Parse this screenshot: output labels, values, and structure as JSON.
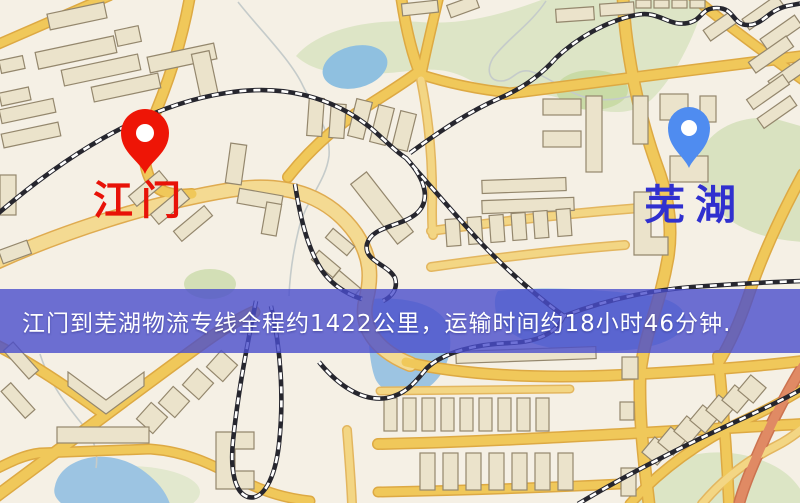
{
  "map": {
    "origin_label": "江门",
    "destination_label": "芜湖",
    "origin_pin_color": "#ee1506",
    "destination_pin_color": "#4f8cf0",
    "origin_label_color": "#e81208",
    "destination_label_color": "#3030cf"
  },
  "banner": {
    "text": "江门到芜湖物流专线全程约1422公里，运输时间约18小时46分钟.",
    "background": "#4a4ecc",
    "text_color": "#ffffff"
  },
  "route_info": {
    "origin": "江门",
    "destination": "芜湖",
    "distance_km": "1422",
    "duration": "18小时46分钟"
  },
  "palette": {
    "background": "#f5f0e5",
    "park": "#dde5c6",
    "park_dark": "#c9dba6",
    "water": "#9cc4e2",
    "stream": "#c5cbca",
    "road": "#f0c85a",
    "road_casing": "#dda943",
    "wide_road": "#f4da92",
    "wide_road_casing": "#dfab50",
    "accent_road": "#e08a64",
    "building": "#ebe3cb",
    "building_outline": "#94876d",
    "railway": "#26262e",
    "railway_dash": "#ffffff"
  }
}
